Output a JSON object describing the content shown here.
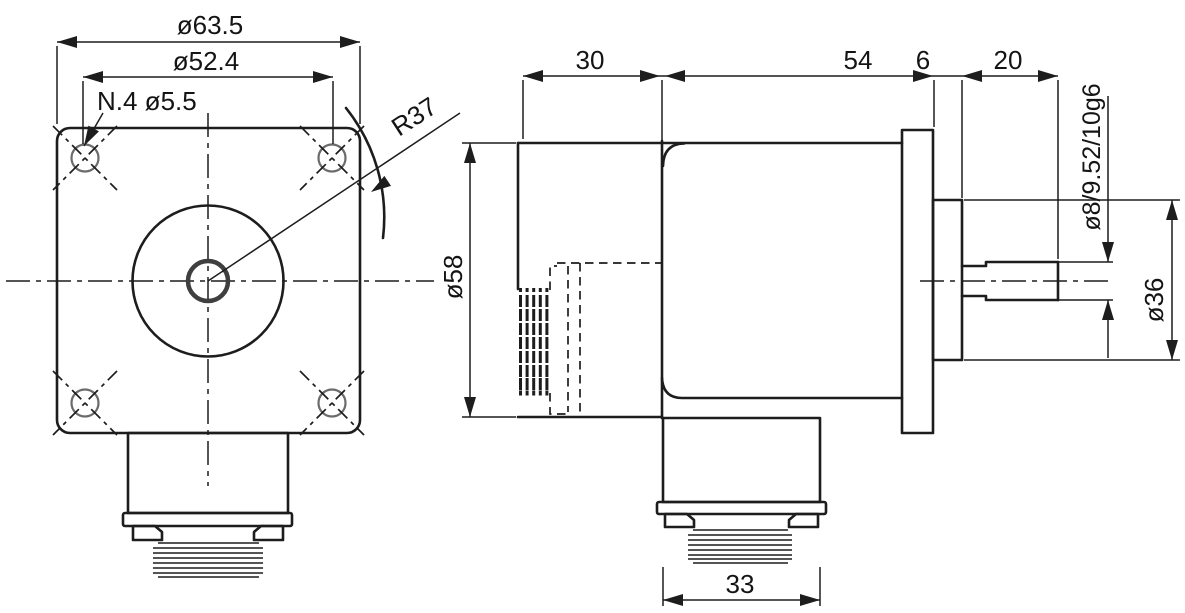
{
  "drawing": {
    "front": {
      "flange_size": "ø63.5",
      "hole_pitch": "ø52.4",
      "mount_holes": "N.4 ø5.5",
      "corner_radius": "R37"
    },
    "side": {
      "rear_length": "30",
      "body_length": "54",
      "pilot_depth": "6",
      "shaft_length": "20",
      "body_diameter": "ø58",
      "shaft_diameter": "ø8/9.52/10g6",
      "pilot_diameter": "ø36",
      "connector_width": "33"
    },
    "colors": {
      "line": "#1d1d1d",
      "background": "#ffffff"
    }
  }
}
